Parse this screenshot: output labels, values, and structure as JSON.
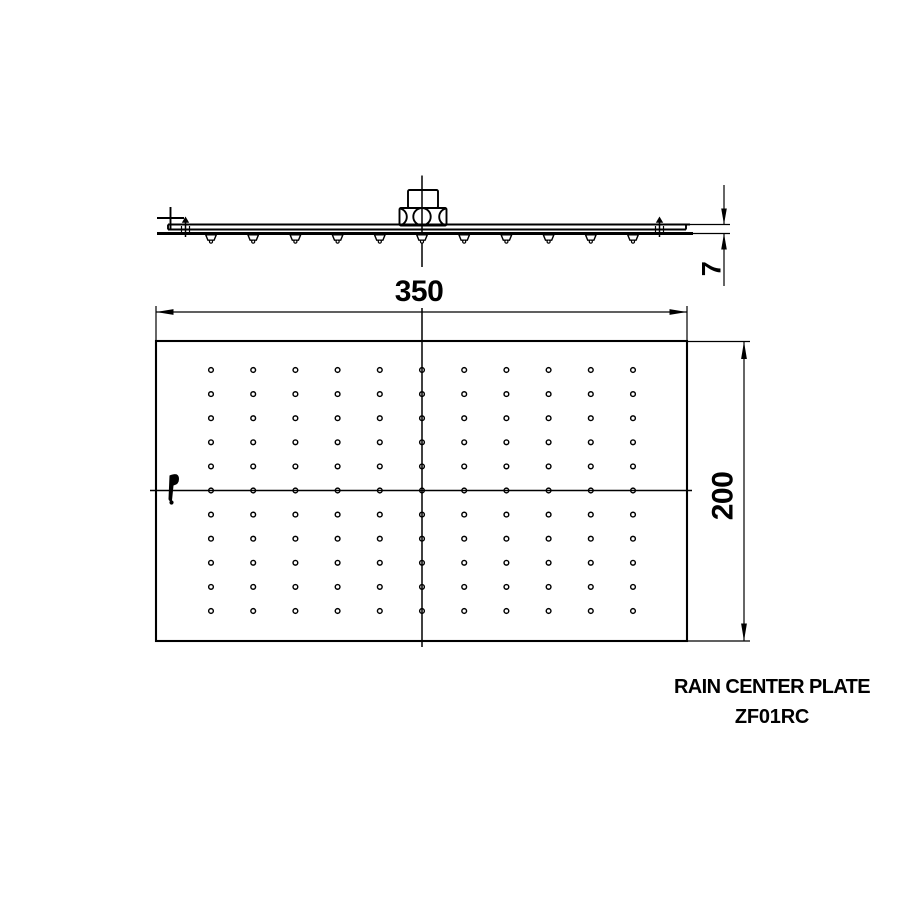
{
  "page": {
    "background_color": "#ffffff",
    "line_color": "#000000"
  },
  "title_block": {
    "product_name": "RAIN CENTER PLATE",
    "product_code": "ZF01RC"
  },
  "dimensions": {
    "width": "350",
    "depth": "200",
    "thickness": "7"
  },
  "plan_view": {
    "hole_grid": {
      "columns": 11,
      "rows": 11
    }
  },
  "side_view": {
    "nozzle_count": 11
  },
  "icons": {
    "brand_mark": "manufacturer-logo-mark",
    "datum_mark": "plus-cross-mark"
  }
}
